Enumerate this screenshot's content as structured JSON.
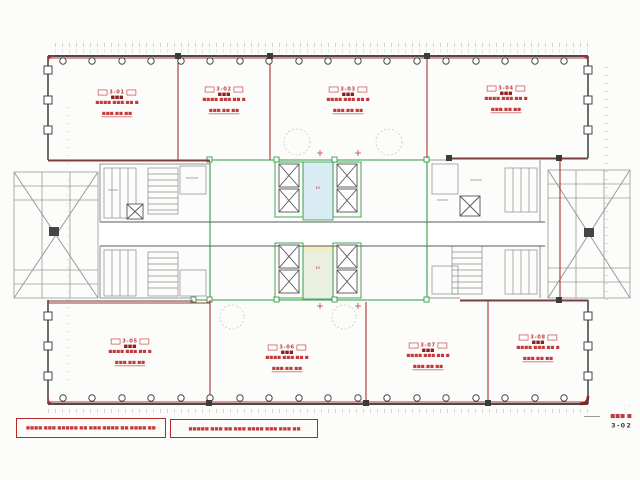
{
  "drawing": {
    "rooms": [
      {
        "unit": "3-01",
        "name": "■■■",
        "area": "■■■■ ■■■.■■ ■",
        "tsubo": "■■■.■■ ■■"
      },
      {
        "unit": "3-02",
        "name": "■■■",
        "area": "■■■■ ■■■.■■ ■",
        "tsubo": "■■■.■■ ■■"
      },
      {
        "unit": "3-03",
        "name": "■■■",
        "area": "■■■■ ■■■.■■ ■",
        "tsubo": "■■■.■■ ■■"
      },
      {
        "unit": "3-04",
        "name": "■■■",
        "area": "■■■■ ■■■.■■ ■",
        "tsubo": "■■■.■■ ■■"
      },
      {
        "unit": "3-05",
        "name": "■■■",
        "area": "■■■■ ■■■.■■ ■",
        "tsubo": "■■■.■■ ■■"
      },
      {
        "unit": "3-06",
        "name": "■■■",
        "area": "■■■■ ■■■.■■ ■",
        "tsubo": "■■■.■■ ■■"
      },
      {
        "unit": "3-07",
        "name": "■■■",
        "area": "■■■■ ■■■.■■ ■",
        "tsubo": "■■■.■■ ■■"
      },
      {
        "unit": "3-08",
        "name": "■■■",
        "area": "■■■■ ■■■.■■ ■",
        "tsubo": "■■■.■■ ■■"
      }
    ],
    "lobby_label": "EV",
    "notes": [
      {
        "text": "■■■■ ■■■ ■■■■■ ■■ ■■■ ■■■■ ■■ ■■■■ ■■"
      },
      {
        "text": "■■■■■ ■■■ ■■ ■■■ ■■■■ ■■■ ■■■ ■■"
      }
    ],
    "legend": {
      "row1": "· · · ·",
      "scale": "■■■ ■",
      "sheet": "3-02"
    },
    "colors": {
      "wall": "#4a4a4a",
      "boundary_red": "#a83232",
      "core_green": "#2f9e44",
      "lobby_blue": "#d9ecf4",
      "lobby_yellow": "#f2edc3"
    }
  }
}
